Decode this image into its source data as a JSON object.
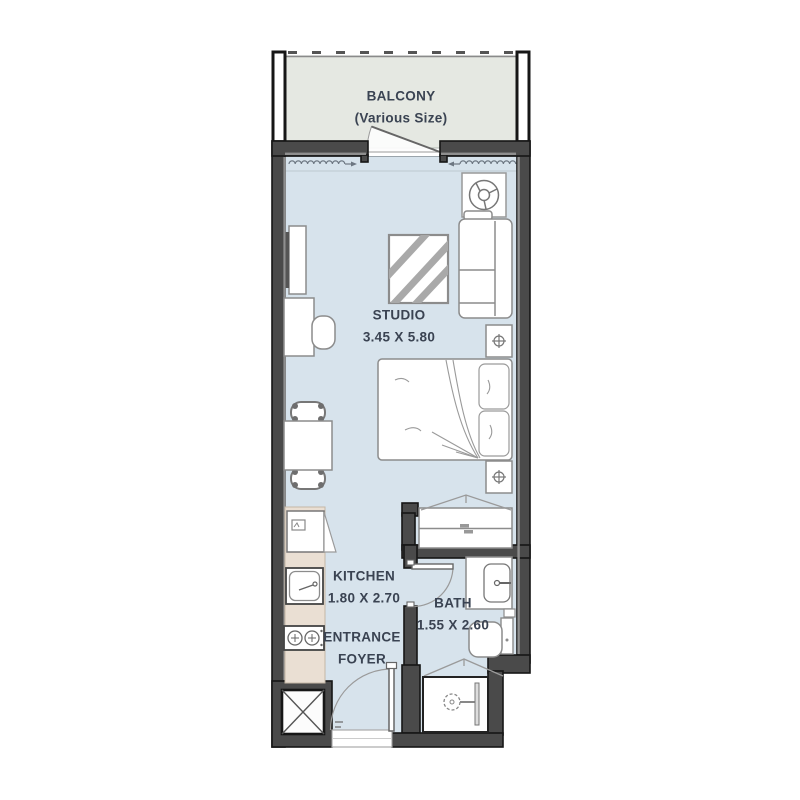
{
  "floorplan": {
    "rooms": {
      "balcony": {
        "name": "BALCONY",
        "size_note": "(Various Size)"
      },
      "studio": {
        "name": "STUDIO",
        "dimensions": "3.45 X 5.80"
      },
      "kitchen": {
        "name": "KITCHEN",
        "dimensions": "1.80 X 2.70"
      },
      "bath": {
        "name": "BATH",
        "dimensions": "1.55 X 2.60"
      },
      "entrance_foyer": {
        "name": "ENTRANCE",
        "name_line2": "FOYER"
      }
    },
    "colors": {
      "wall": "#4a4a4a",
      "wall_outline": "#161616",
      "wall_inner_stripe": "#8f8f8f",
      "studio_floor": "#d7e3ec",
      "balcony_floor": "#e5e8e2",
      "kitchen_counter": "#eadfd3",
      "furniture_outline": "#8c8c8c",
      "label_text": "#3a4352"
    },
    "icons": [
      "ceiling-fan-icon",
      "sofa",
      "rug",
      "tv-unit",
      "desk",
      "desk-chair",
      "dining-table",
      "dining-chair",
      "double-bed",
      "bedside-table",
      "wardrobe",
      "kitchen-appliance",
      "kitchen-sink",
      "hob",
      "vanity-basin",
      "toilet",
      "shower",
      "service-shaft",
      "entrance-door",
      "bath-door",
      "balcony-door",
      "curtain-track"
    ]
  }
}
